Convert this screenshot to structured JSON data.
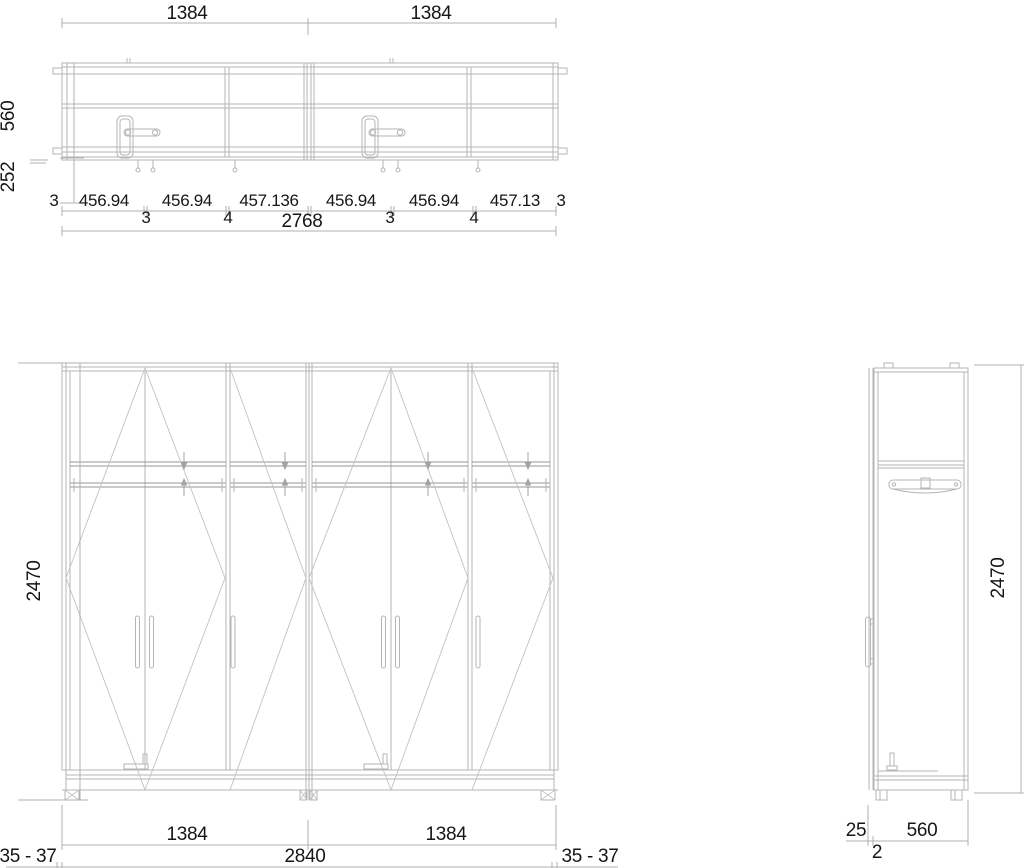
{
  "colors": {
    "background": "#ffffff",
    "line": "#b5b5b5",
    "line_dark": "#949494",
    "text": "#161616"
  },
  "plan_view": {
    "top_widths": [
      "1384",
      "1384"
    ],
    "depth": "560",
    "front_extension": "252",
    "segment_widths": [
      "3",
      "456.94",
      "456.94",
      "457.136",
      "456.94",
      "456.94",
      "457.13",
      "3"
    ],
    "gap_widths": [
      "3",
      "4",
      "3",
      "4"
    ],
    "total_width": "2768"
  },
  "front_view": {
    "height": "2470",
    "module_widths": [
      "1384",
      "1384"
    ],
    "total_width": "2840",
    "clearance_left": "35 - 37",
    "clearance_right": "35 - 37"
  },
  "side_view": {
    "height": "2470",
    "depth": "560",
    "door_offset": "25",
    "gap": "2"
  }
}
